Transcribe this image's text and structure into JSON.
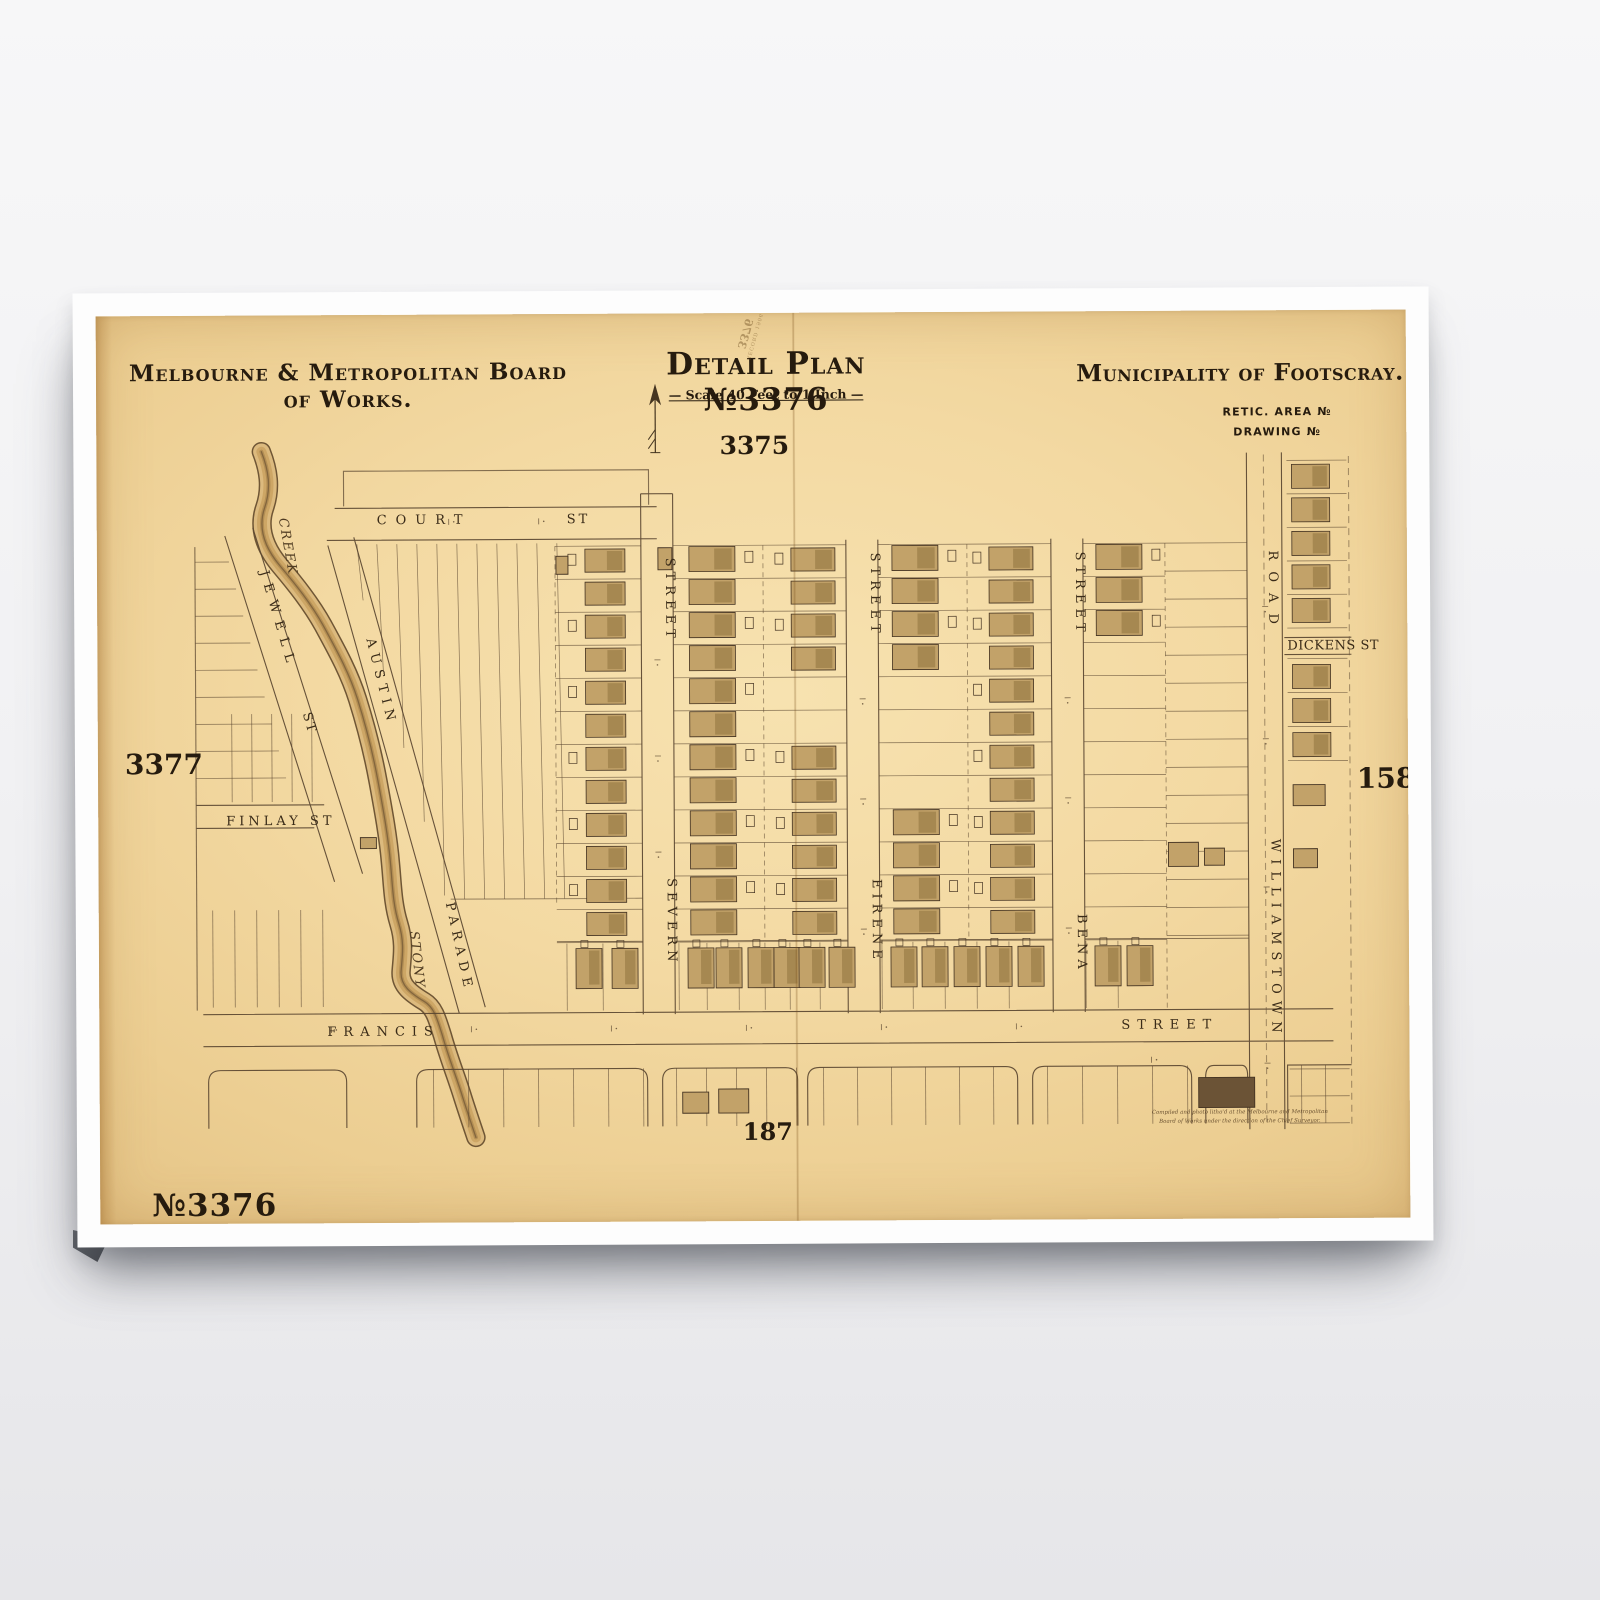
{
  "poster": {
    "publisher": "Melbourne & Metropolitan Board of Works.",
    "plan_title": "Detail Plan №3376",
    "scale_note": "— Scale 40 Feet to 1 Inch —",
    "municipality": "Municipality of Footscray.",
    "retic_area": "RETIC. AREA №",
    "drawing_no": "DRAWING №",
    "plate_top": "3375",
    "plate_left": "3377",
    "plate_right": "158",
    "plate_bottom": "187",
    "plan_no_stamp": "№3376",
    "bleed_stamp_number": "3376",
    "bleed_stamp_note": "RECORD 1906",
    "imprint_line1": "Compiled and photo litho'd at the Melbourne and Metropolitan",
    "imprint_line2": "Board of Works under the direction of the Chief Surveyor."
  },
  "streets": {
    "court": "COURT",
    "severn": "SEVERN",
    "eirene": "EIRENE",
    "bena": "BENA",
    "williamstown": "WILLIAMSTOWN",
    "road": "ROAD",
    "francis": "FRANCIS",
    "street_word": "STREET",
    "st_word": "ST",
    "jewell": "JEWELL",
    "austin": "AUSTIN",
    "parade": "PARADE",
    "finlay": "FINLAY ST",
    "dickens": "DICKENS ST",
    "stony": "STONY",
    "creek": "CREEK"
  },
  "map": {
    "ink": "#5b4731",
    "house_fill": "#c2a269",
    "house_fill_dark": "#a3854f",
    "house_stroke": "#443322",
    "creek_path": "M263,450 C270,468 273,486 266,506 C259,526 266,546 281,564 C296,582 312,602 324,624 C338,650 350,672 358,698 C366,724 373,752 378,780 C383,808 388,836 390,862 C392,884 392,902 398,922 C404,942 401,956 400,970 C399,984 410,992 423,1000 C433,1006 436,1018 441,1034 C447,1056 455,1076 461,1096 C466,1112 470,1124 474,1136",
    "creek_strokes": [
      [
        "#6f5635",
        19.5,
        1
      ],
      [
        "#dcba7e",
        16.5,
        1
      ],
      [
        "#c39a55",
        10,
        0.6
      ],
      [
        "#8a6a3a",
        4,
        0.4
      ],
      [
        "#6f5635",
        1.3,
        0.7
      ]
    ],
    "house_columns": [
      {
        "x": 586,
        "w": 40,
        "h": 23,
        "y0": 549,
        "step": 33,
        "count": 12,
        "skip": [],
        "out": -17
      },
      {
        "x": 690,
        "w": 46,
        "h": 25,
        "y0": 547,
        "step": 33,
        "count": 12,
        "skip": [],
        "out": 56
      },
      {
        "x": 792,
        "w": 44,
        "h": 23,
        "y0": 549,
        "step": 33,
        "count": 12,
        "skip": [
          4,
          5
        ],
        "out": -16
      },
      {
        "x": 893,
        "w": 46,
        "h": 25,
        "y0": 547,
        "step": 33,
        "count": 12,
        "skip": [
          4,
          5,
          6,
          7
        ],
        "out": 56
      },
      {
        "x": 990,
        "w": 44,
        "h": 23,
        "y0": 549,
        "step": 33,
        "count": 12,
        "skip": [],
        "out": -16
      },
      {
        "x": 1097,
        "w": 46,
        "h": 25,
        "y0": 547,
        "step": 33,
        "count": 3,
        "skip": [],
        "out": 56
      },
      {
        "x": 1293,
        "w": 38,
        "h": 24,
        "y0": 468,
        "step": 33.5,
        "count": 5,
        "skip": [],
        "out": 0
      },
      {
        "x": 1293,
        "w": 38,
        "h": 24,
        "y0": 668,
        "step": 34,
        "count": 3,
        "skip": [],
        "out": 0
      }
    ],
    "francis_row": {
      "y": 948,
      "h": 40,
      "w": 26,
      "xs": [
        575,
        611,
        687,
        715,
        747,
        773,
        798,
        828,
        890,
        921,
        953,
        985,
        1017,
        1094,
        1126
      ]
    },
    "single_buildings": [
      {
        "x": 1168,
        "y": 845,
        "w": 30,
        "h": 24
      },
      {
        "x": 1204,
        "y": 851,
        "w": 20,
        "h": 17
      },
      {
        "x": 1293,
        "y": 788,
        "w": 32,
        "h": 21
      },
      {
        "x": 1293,
        "y": 852,
        "w": 24,
        "h": 19
      },
      {
        "x": 1197,
        "y": 1080,
        "w": 56,
        "h": 30,
        "dark": true
      },
      {
        "x": 681,
        "y": 1092,
        "w": 26,
        "h": 21
      },
      {
        "x": 717,
        "y": 1089,
        "w": 30,
        "h": 24
      },
      {
        "x": 360,
        "y": 836,
        "w": 16,
        "h": 11
      },
      {
        "x": 557,
        "y": 556,
        "w": 12,
        "h": 18
      },
      {
        "x": 659,
        "y": 548,
        "w": 14,
        "h": 22
      }
    ],
    "lot_hline_groups": [
      {
        "x1": 556,
        "x2": 642,
        "y0": 546,
        "step": 33,
        "count": 13
      },
      {
        "x1": 674,
        "x2": 764,
        "y0": 546,
        "step": 33,
        "count": 13
      },
      {
        "x1": 764,
        "x2": 847,
        "y0": 546,
        "step": 33,
        "count": 13
      },
      {
        "x1": 879,
        "x2": 968,
        "y0": 546,
        "step": 33,
        "count": 13
      },
      {
        "x1": 968,
        "x2": 1052,
        "y0": 546,
        "step": 33,
        "count": 13
      },
      {
        "x1": 1084,
        "x2": 1166,
        "y0": 546,
        "step": 33,
        "count": 13
      },
      {
        "x1": 1166,
        "x2": 1248,
        "y0": 546,
        "step": 28,
        "count": 15
      },
      {
        "x1": 1288,
        "x2": 1348,
        "y0": 464,
        "step": 33.5,
        "count": 6
      },
      {
        "x1": 1288,
        "x2": 1348,
        "y0": 662,
        "step": 34,
        "count": 4
      },
      {
        "x1": 1288,
        "x2": 1348,
        "y0": 1072,
        "step": 27,
        "count": 3
      },
      {
        "x1": 196,
        "x2": 230,
        "x2_step": 7,
        "y0": 560,
        "step": 27,
        "count": 9
      }
    ],
    "lot_vline_groups": [
      {
        "x0": 232,
        "step": 20,
        "count": 5,
        "y1": 712,
        "y2": 800
      },
      {
        "x0": 212,
        "step": 22,
        "count": 6,
        "y1": 908,
        "y2": 1005
      },
      {
        "x0": 432,
        "step": 35,
        "count": 7,
        "y1": 1068,
        "y2": 1126
      },
      {
        "x0": 675,
        "step": 30,
        "count": 5,
        "y1": 1068,
        "y2": 1126
      },
      {
        "x0": 822,
        "step": 34,
        "count": 6,
        "y1": 1068,
        "y2": 1126
      },
      {
        "x0": 1046,
        "step": 35,
        "count": 5,
        "y1": 1068,
        "y2": 1126
      },
      {
        "x0": 1300,
        "step": 24,
        "count": 2,
        "y1": 1068,
        "y2": 1126
      }
    ],
    "austin_lines": {
      "x0": 358,
      "step": 20,
      "count": 11,
      "y_top": 543
    },
    "ticks": [
      [
        450,
        521,
        "h"
      ],
      [
        540,
        521,
        "h"
      ],
      [
        658,
        660,
        "v"
      ],
      [
        658,
        756,
        "v"
      ],
      [
        658,
        852,
        "v"
      ],
      [
        863,
        700,
        "v"
      ],
      [
        863,
        800,
        "v"
      ],
      [
        863,
        930,
        "v"
      ],
      [
        1068,
        700,
        "v"
      ],
      [
        1068,
        800,
        "v"
      ],
      [
        1068,
        930,
        "v"
      ],
      [
        1266,
        610,
        "v"
      ],
      [
        1266,
        742,
        "v"
      ],
      [
        1266,
        890,
        "v"
      ],
      [
        1266,
        1066,
        "v"
      ],
      [
        330,
        1028,
        "h"
      ],
      [
        470,
        1028,
        "h"
      ],
      [
        610,
        1028,
        "h"
      ],
      [
        745,
        1028,
        "h"
      ],
      [
        880,
        1028,
        "h"
      ],
      [
        1015,
        1028,
        "h"
      ],
      [
        1150,
        1062,
        "h"
      ]
    ]
  }
}
